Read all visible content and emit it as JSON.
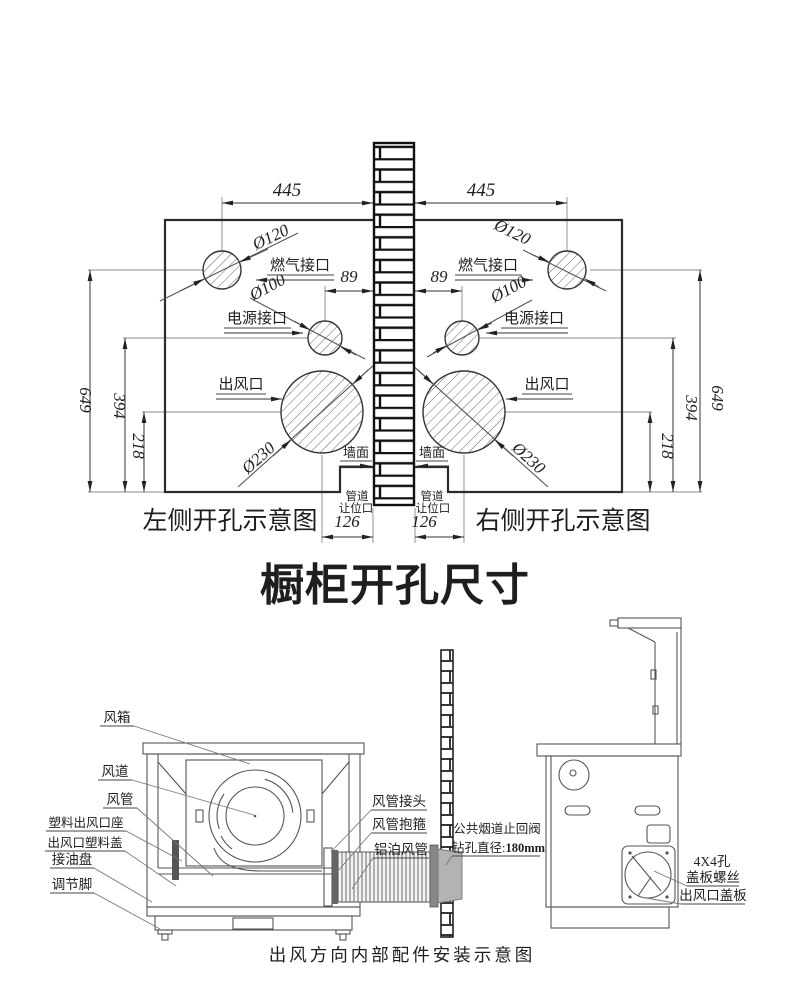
{
  "top": {
    "dim445": "445",
    "dim89": "89",
    "dim126": "126",
    "dim649": "649",
    "dim394": "394",
    "dim218": "218",
    "dia120": "Ø120",
    "dia100": "Ø100",
    "dia230": "Ø230",
    "gas": "燃气接口",
    "power": "电源接口",
    "outlet": "出风口",
    "wall": "墙面",
    "pipe1": "管道",
    "pipe2": "让位口",
    "caption_left": "左侧开孔示意图",
    "caption_right": "右侧开孔示意图"
  },
  "title": "橱柜开孔尺寸",
  "bottom": {
    "fan_box": "风箱",
    "duct": "风道",
    "pipe": "风管",
    "plastic_seat": "塑料出风口座",
    "plastic_cover": "出风口塑料盖",
    "oil_tray": "接油盘",
    "feet": "调节脚",
    "pipe_joint": "风管接头",
    "pipe_clamp": "风管抱箍",
    "alu_pipe": "铝泊风管",
    "valve1": "公共烟道止回阀",
    "valve2": "钻孔直径:",
    "valve2b": "180mm",
    "holes": "4X4孔",
    "screws": "盖板螺丝",
    "cover_plate": "出风口盖板",
    "caption": "出风方向内部配件安装示意图"
  },
  "colors": {
    "line": "#2b2b2b",
    "gray_fill": "#b3b3b3",
    "dark_fill": "#666666"
  }
}
